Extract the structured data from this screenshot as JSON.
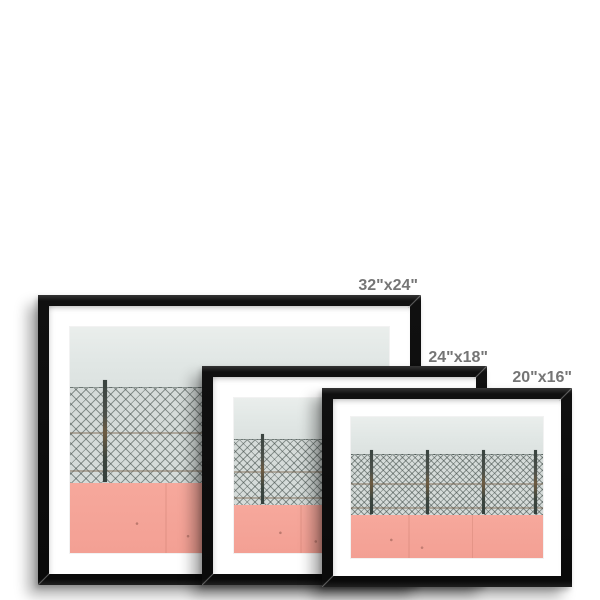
{
  "frames": [
    {
      "size_label": "32\"x24\""
    },
    {
      "size_label": "24\"x18\""
    },
    {
      "size_label": "20\"x16\""
    }
  ],
  "colors": {
    "background": "#ffffff",
    "frame_black": "#101010",
    "mat_white": "#ffffff",
    "label_gray": "#757575",
    "wall_top_gray": "#e1e7e5",
    "fence_gray": "#d5dbd9",
    "wall_pink": "#f5a296"
  }
}
